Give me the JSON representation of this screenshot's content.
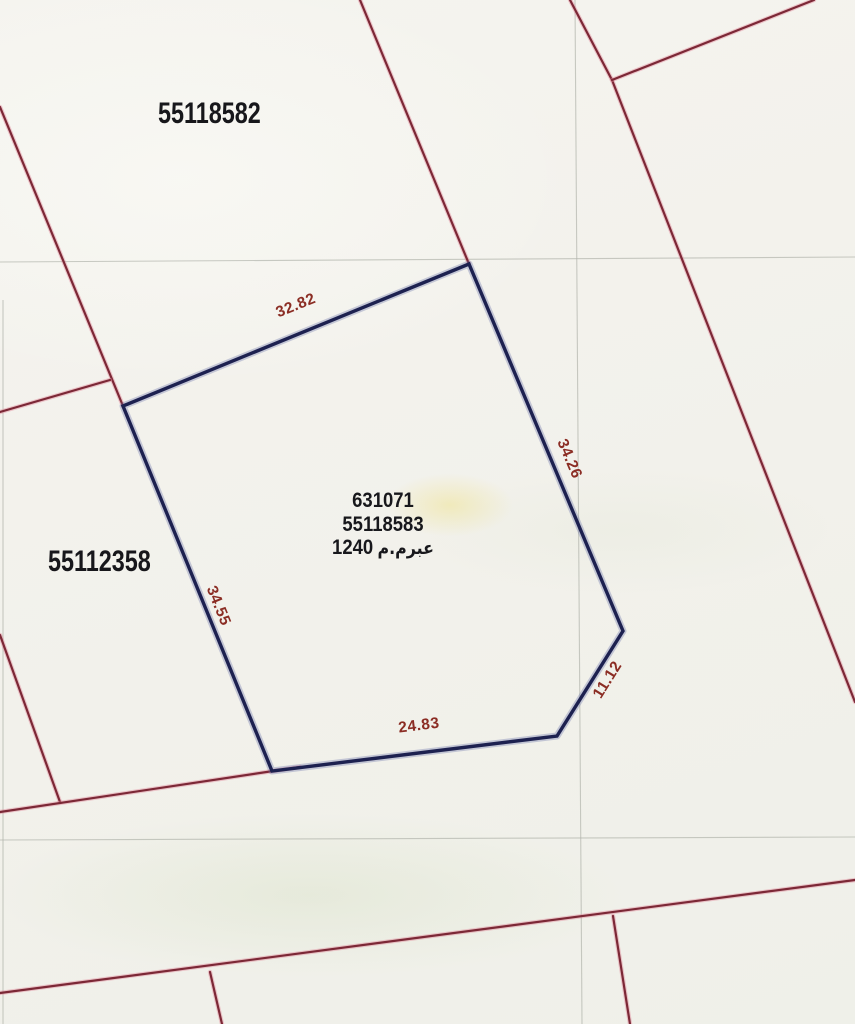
{
  "window": {
    "width": 855,
    "height": 1024
  },
  "map": {
    "type": "cadastral-survey-plan",
    "colors": {
      "paper": "#f3f2ec",
      "boundary_line": "#7c2836",
      "boundary_halo": "rgba(224,130,150,0.42)",
      "highlight_line": "#1d2150",
      "highlight_halo": "rgba(95,105,165,0.32)",
      "dimension_text": "#8b2d24",
      "parcel_text": "#17171b",
      "grid_line": "#b2b5ac"
    },
    "parcels": [
      {
        "label": "55118582"
      },
      {
        "label": "55112358"
      }
    ],
    "highlight_plot": {
      "plan_number": "631071",
      "parcel_number": "55118583",
      "area_value": "1240",
      "area_unit": "م.مربع",
      "vertices": [
        [
          123,
          406
        ],
        [
          469,
          264
        ],
        [
          623,
          631
        ],
        [
          557,
          736
        ],
        [
          272,
          771
        ]
      ],
      "dimensions": [
        {
          "value": "32.82",
          "x": 296,
          "y": 306,
          "angle": -22
        },
        {
          "value": "34.26",
          "x": 569,
          "y": 459,
          "angle": 67
        },
        {
          "value": "34.55",
          "x": 218,
          "y": 606,
          "angle": 68
        },
        {
          "value": "24.83",
          "x": 419,
          "y": 726,
          "angle": -7
        },
        {
          "value": "11.12",
          "x": 608,
          "y": 680,
          "angle": -58
        }
      ]
    },
    "boundary_lines": [
      {
        "name": "west-upper-boundary",
        "points": [
          [
            0,
            107
          ],
          [
            123,
            406
          ]
        ]
      },
      {
        "name": "west-horizontal-boundary",
        "points": [
          [
            0,
            412
          ],
          [
            110,
            380
          ]
        ]
      },
      {
        "name": "west-lower-boundary",
        "points": [
          [
            0,
            635
          ],
          [
            60,
            802
          ]
        ]
      },
      {
        "name": "road-upper-edge",
        "points": [
          [
            0,
            812
          ],
          [
            300,
            767
          ]
        ]
      },
      {
        "name": "road-lower-edge",
        "points": [
          [
            0,
            993
          ],
          [
            855,
            880
          ]
        ]
      },
      {
        "name": "south-branch-left",
        "points": [
          [
            210,
            972
          ],
          [
            222,
            1024
          ]
        ]
      },
      {
        "name": "south-branch-right",
        "points": [
          [
            613,
            916
          ],
          [
            630,
            1024
          ]
        ]
      },
      {
        "name": "northeast-boundary",
        "points": [
          [
            570,
            0
          ],
          [
            612,
            80
          ],
          [
            855,
            702
          ]
        ]
      },
      {
        "name": "northeast-branch",
        "points": [
          [
            612,
            80
          ],
          [
            814,
            0
          ]
        ]
      },
      {
        "name": "north-boundary",
        "points": [
          [
            360,
            0
          ],
          [
            469,
            264
          ]
        ]
      }
    ],
    "grid_lines": [
      {
        "name": "grid-horizontal-1",
        "points": [
          [
            0,
            262
          ],
          [
            855,
            257
          ]
        ]
      },
      {
        "name": "grid-horizontal-2",
        "points": [
          [
            0,
            840
          ],
          [
            855,
            837
          ]
        ]
      },
      {
        "name": "grid-vertical-1",
        "points": [
          [
            575,
            0
          ],
          [
            582,
            1024
          ]
        ]
      },
      {
        "name": "grid-vertical-2",
        "points": [
          [
            3,
            300
          ],
          [
            3,
            1024
          ]
        ]
      }
    ]
  }
}
